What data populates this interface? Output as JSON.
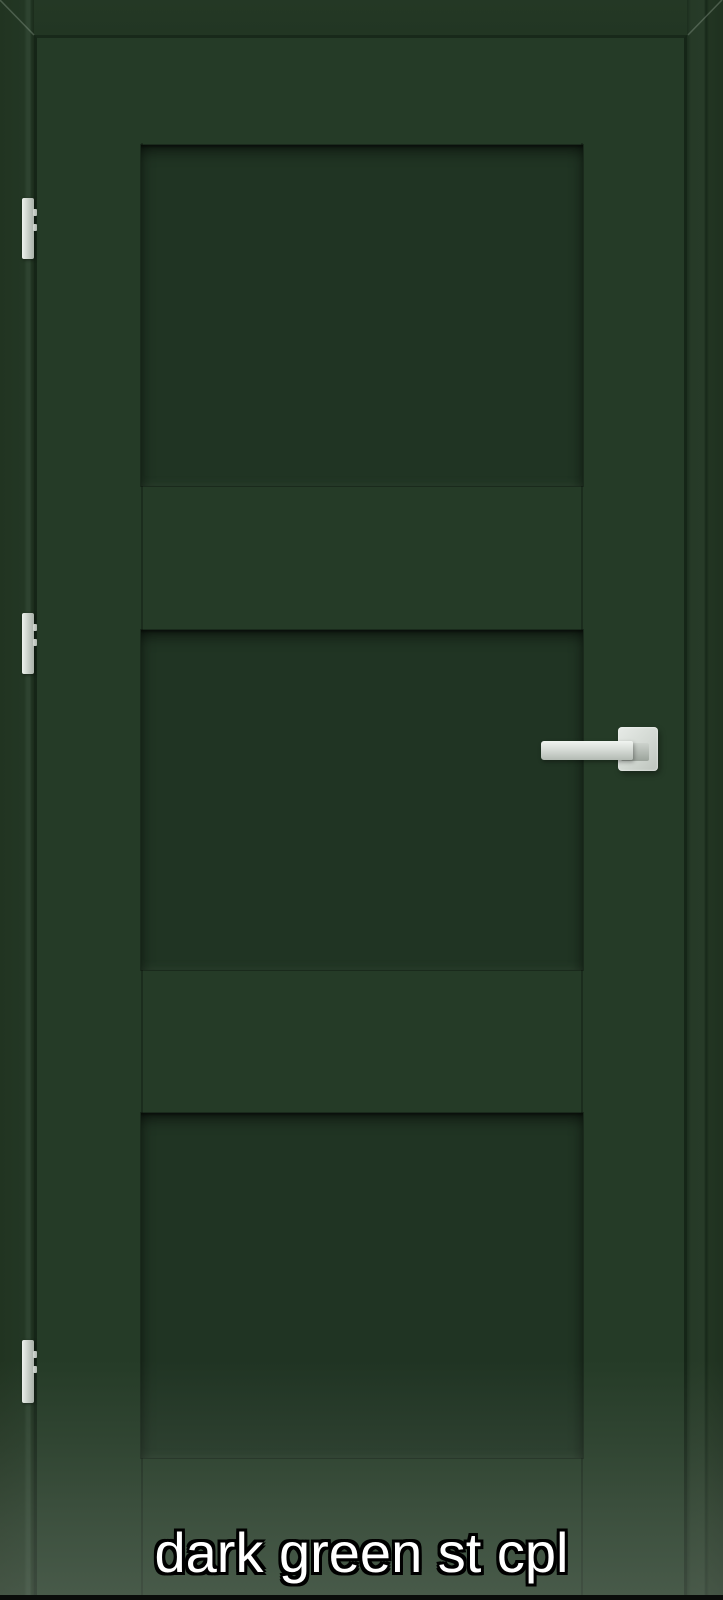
{
  "product": {
    "caption": "dark green st cpl"
  },
  "theme": {
    "frame-green": "#223623",
    "door-green": "#253b27",
    "panel-green": "#203423",
    "hardware-light": "#eef2ee",
    "hardware-mid": "#c6cdc6",
    "hardware-dark": "#a9b1a9",
    "caption-color": "#ffffff",
    "caption-outline": "#000000",
    "bottom-bar": "#0a0c0a"
  },
  "door": {
    "panel_count": 3,
    "hinge_count": 3
  }
}
